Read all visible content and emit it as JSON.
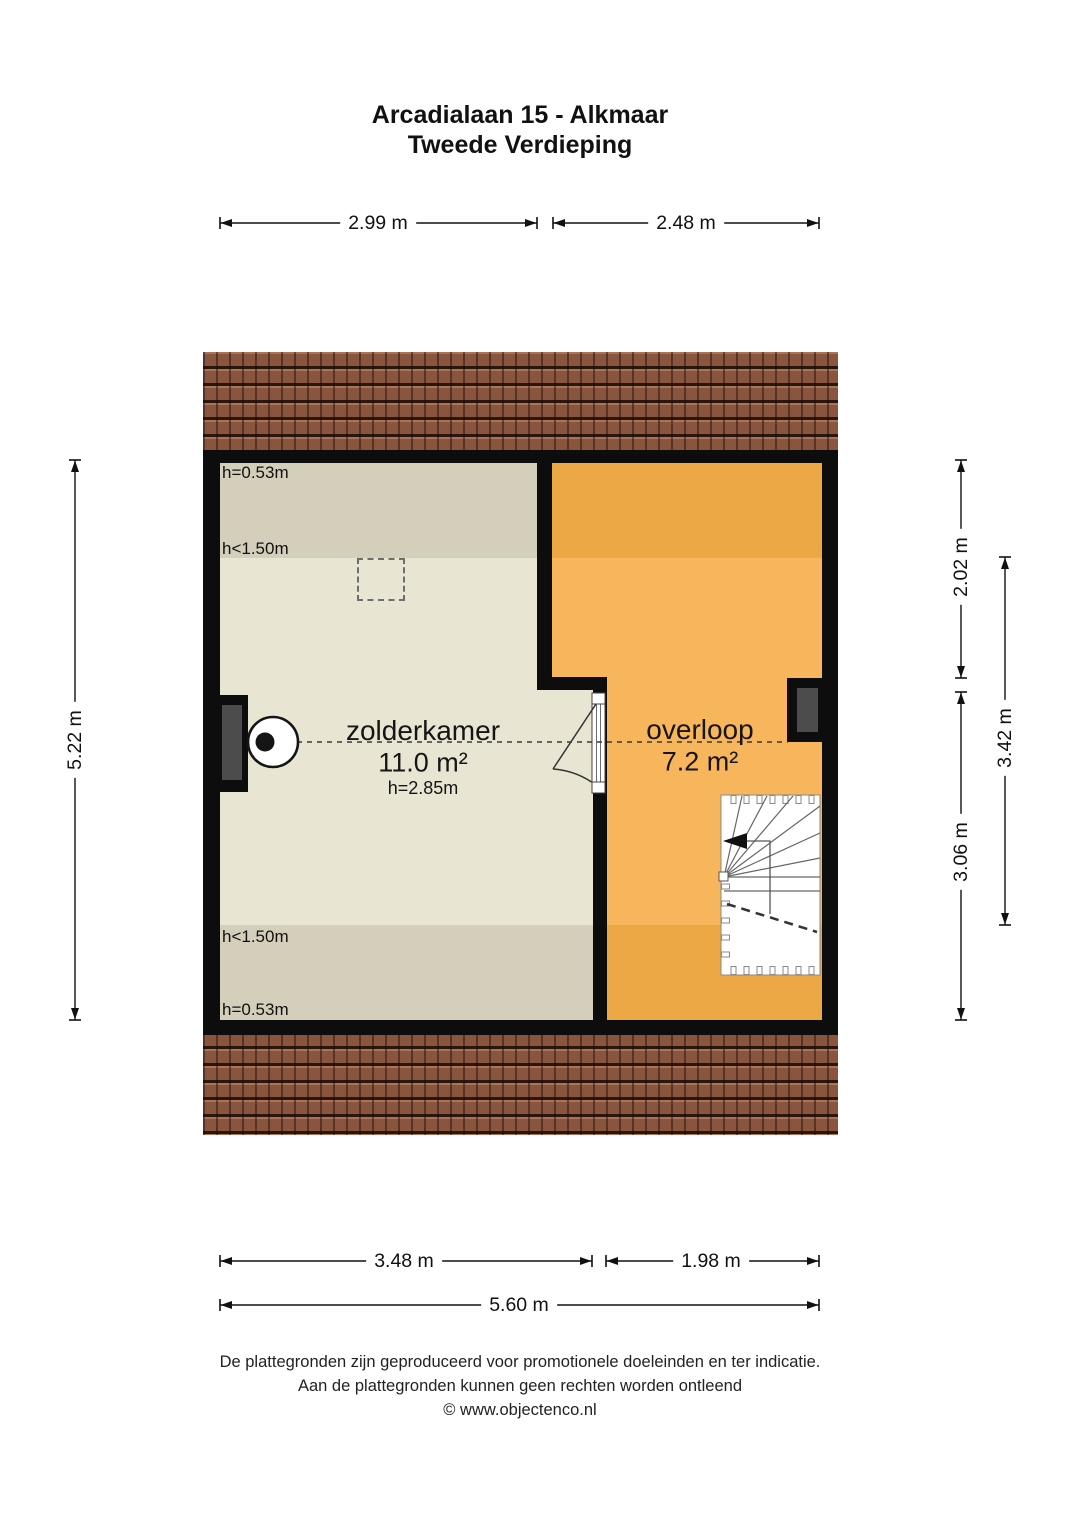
{
  "title": {
    "line1": "Arcadialaan 15 - Alkmaar",
    "line2": "Tweede Verdieping"
  },
  "rooms": {
    "zolderkamer": {
      "name": "zolderkamer",
      "area": "11.0 m²",
      "ceiling_height": "h=2.85m"
    },
    "overloop": {
      "name": "overloop",
      "area": "7.2 m²"
    }
  },
  "zone_labels": {
    "top_eave": "h=0.53m",
    "top_kneewall": "h<1.50m",
    "bottom_kneewall": "h<1.50m",
    "bottom_eave": "h=0.53m"
  },
  "dimensions": {
    "top_left": "2.99 m",
    "top_right": "2.48 m",
    "left": "5.22 m",
    "right_upper": "2.02 m",
    "right_outer": "3.42 m",
    "right_lower": "3.06 m",
    "bottom_left": "3.48 m",
    "bottom_right": "1.98 m",
    "bottom_total": "5.60 m"
  },
  "footer": {
    "line1": "De plattegronden zijn geproduceerd voor promotionele doeleinden en ter indicatie.",
    "line2": "Aan de plattegronden kunnen geen rechten worden ontleend",
    "line3": "© www.objectenco.nl"
  },
  "colors": {
    "wall": "#0d0d0d",
    "zolderkamer_floor": "#e9e5d3",
    "zolderkamer_low_zone": "#d4cfbb",
    "overloop_floor": "#f7b55c",
    "overloop_low_zone": "#eba844",
    "roof_tiles": "#8a553e",
    "window_glass": "#4c4c4c"
  }
}
